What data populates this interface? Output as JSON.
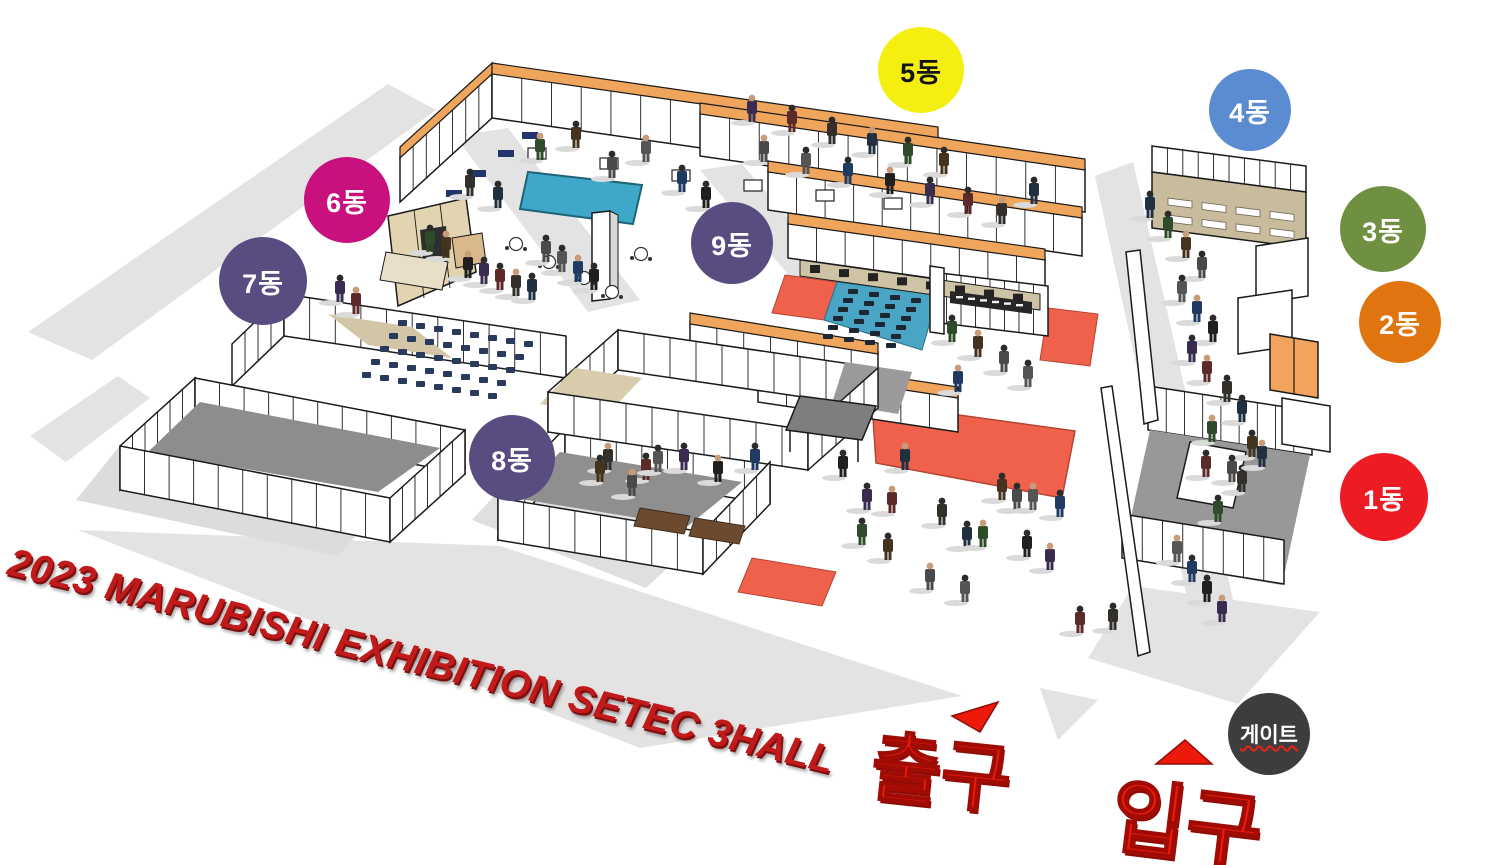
{
  "title": "2023 MARUBISHI EXHIBITION SETEC 3HALL",
  "zones": [
    {
      "id": "zone-1",
      "label": "1동",
      "color": "#ed1c24",
      "text_color": "#ffffff",
      "x": 1384,
      "y": 497,
      "r": 44
    },
    {
      "id": "zone-2",
      "label": "2동",
      "color": "#e0740f",
      "text_color": "#ffffff",
      "x": 1400,
      "y": 322,
      "r": 41
    },
    {
      "id": "zone-3",
      "label": "3동",
      "color": "#6f9040",
      "text_color": "#ffffff",
      "x": 1383,
      "y": 229,
      "r": 43
    },
    {
      "id": "zone-4",
      "label": "4동",
      "color": "#5b8bd0",
      "text_color": "#ffffff",
      "x": 1250,
      "y": 110,
      "r": 41
    },
    {
      "id": "zone-5",
      "label": "5동",
      "color": "#f4ef10",
      "text_color": "#141414",
      "x": 921,
      "y": 70,
      "r": 43
    },
    {
      "id": "zone-6",
      "label": "6동",
      "color": "#c8117e",
      "text_color": "#ffffff",
      "x": 347,
      "y": 200,
      "r": 43
    },
    {
      "id": "zone-7",
      "label": "7동",
      "color": "#594c81",
      "text_color": "#ffffff",
      "x": 263,
      "y": 281,
      "r": 44
    },
    {
      "id": "zone-8",
      "label": "8동",
      "color": "#594c81",
      "text_color": "#ffffff",
      "x": 512,
      "y": 458,
      "r": 43
    },
    {
      "id": "zone-9",
      "label": "9동",
      "color": "#594c81",
      "text_color": "#ffffff",
      "x": 732,
      "y": 243,
      "r": 41
    }
  ],
  "markers": {
    "exit": {
      "label": "출구"
    },
    "entrance": {
      "label": "입구"
    },
    "gate": {
      "label": "게이트",
      "color": "#3d3d3d",
      "text_color": "#ffffff",
      "x": 1269,
      "y": 734,
      "r": 41
    }
  },
  "colors": {
    "title_red": "#c11a1a",
    "marker_red": "#ed1a0c",
    "beam_orange": "#efa55b",
    "cabinet_orange": "#f2a45c",
    "teal_floor": "#3fa8c8",
    "blue_mat": "#4aa4c4",
    "carpet_red": "#f0614b",
    "navy_seat": "#2a3a5c",
    "black_seat": "#1d2733",
    "tan_floor": "#d2c6a6",
    "tan_wall": "#c8bc9d",
    "gray_floor": "#8f8f8f",
    "wall_stroke": "#1a1a1a",
    "shadow_gray": "#e3e3e3"
  }
}
